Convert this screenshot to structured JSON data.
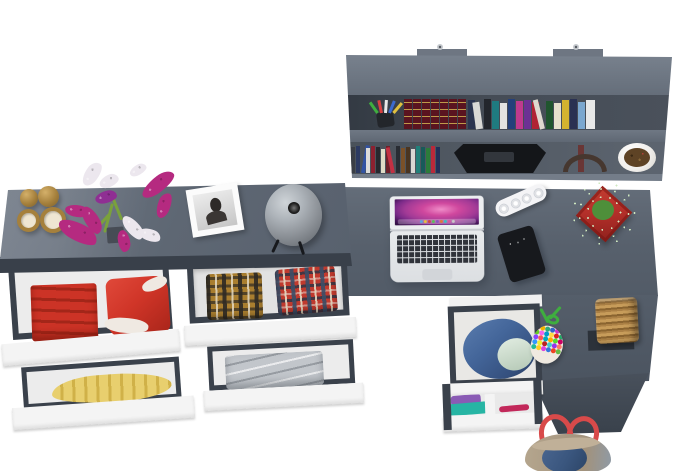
{
  "scene": {
    "type": "3d-furniture-render-top-view",
    "description": "Overhead 3D render of a grey L-shaped desk with wall shelf full of books, a sideboard dresser with open drawers of folded clothes, an open laptop, smartphone, power strip and decorative objects on a white floor",
    "width": 700,
    "height": 471
  },
  "objects": {
    "wall_shelf": "wall-mounted shelf with books, pencil cup, black case, red handbag, planter bowl",
    "dresser": "grey sideboard with candle holders, flower bouquet, photo frame, table lamp",
    "dresser_drawers": "open drawers with red towels, red garment, yellow fabric, two plaid shirts, grey folded sheets",
    "desk": "grey L-shaped desk with open laptop, white power strip, smartphone, potted succulent",
    "drawer_unit": "under-desk drawer unit with blue denim pile and purple, teal and pink folded clothes",
    "return_items": "bead pouch with green cord, wicker basket on dark mat",
    "tote": "canvas and denim tote bag with red straps at desk foot"
  },
  "colors": {
    "floor": "#ffffff",
    "shelf-top": "#6e7682",
    "metal": "#c4c8cd",
    "frame-dark": "#3a414b",
    "drawer-white": "#f4f4f4",
    "interior-white": "#ececec",
    "towel-red": "#cc3326",
    "towel-red-dark": "#a32619",
    "garment-red": "#d03528",
    "garment-white": "#efe9e2",
    "yellow-fabric": "#e8cf6e",
    "yellow-fabric-dark": "#d0b148",
    "sheet-gray": "#c2c6cb",
    "plaid-brown": "#a97e2f",
    "plaid-red": "#c03a2e",
    "denim-blue": "#44669a",
    "denim-dark": "#35507e",
    "denim-light": "#dde9dd",
    "purple-cloth": "#8a5bb5",
    "teal-cloth": "#27b5a4",
    "pink-cloth": "#c2285a",
    "encyclopedia": "#5a1420",
    "encyclopedia-gold": "#caa84e",
    "bag-red": "#e04535",
    "bag-handle": "#46372f",
    "bowl-white": "#f1efec",
    "bowl-soil": "#5e4325",
    "frame-white": "#fbfbfb",
    "photo-bg": "#c6c6c6",
    "brass": "#a5803c",
    "brass-dark": "#7c5f2a",
    "candle-cream": "#efe6d2",
    "flower-magenta": "#b52a80",
    "flower-violet": "#8f2f93",
    "flower-white": "#ece7ee",
    "flower-stem": "#7aa13c",
    "vase-dark": "#474c55",
    "plant-green": "#4e8f3a",
    "plant-green-light": "#7ec06a",
    "pot-red": "#b5302a",
    "pot-red-dark": "#8e211d",
    "basket-dark": "#8a6430",
    "mat-dark": "#2c323a",
    "candy-cord": "#3fae3f",
    "tote-tan": "#b5a68e",
    "tote-denim": "#3a567e",
    "tote-strap": "#d84a4a",
    "laptop-silver": "#e8eaec",
    "laptop-key": "#30333a",
    "screen-pink": "#d0489e",
    "screen-purple": "#7a2a88",
    "screen-dark": "#2a0b3a",
    "phone-black": "#17191d",
    "phone-screen": "#3c5a6a",
    "strip-white": "#f4f4f6"
  },
  "pens": [
    {
      "c": "#3fae3f",
      "r": -35
    },
    {
      "c": "#d84040",
      "r": -12
    },
    {
      "c": "#e8e8e8",
      "r": 4
    },
    {
      "c": "#3a6ad0",
      "r": 22
    },
    {
      "c": "#e0c040",
      "r": 40
    }
  ],
  "books": {
    "encyclopedia": [
      "#5a1420",
      "#5a1420",
      "#5a1420",
      "#5a1420",
      "#5a1420",
      "#5a1420",
      "#5a1420"
    ],
    "upper_right": [
      {
        "c": "#2b3550",
        "h": 29
      },
      {
        "c": "#d9d9d6",
        "h": 27,
        "r": -8
      },
      {
        "c": "#23262c",
        "h": 30
      },
      {
        "c": "#1f7b80",
        "h": 28
      },
      {
        "c": "#e3e3e0",
        "h": 26
      },
      {
        "c": "#24407a",
        "h": 30
      },
      {
        "c": "#bf3a8e",
        "h": 28
      },
      {
        "c": "#6c3194",
        "h": 29
      },
      {
        "c": "#b02334",
        "h": 27
      },
      {
        "c": "#ded9cf",
        "h": 30,
        "r": -14,
        "w": 5
      },
      {
        "c": "#20552e",
        "h": 28
      },
      {
        "c": "#e6e0cc",
        "h": 26
      },
      {
        "c": "#d3b32f",
        "h": 29
      },
      {
        "c": "#2a3152",
        "h": 30
      },
      {
        "c": "#7ba7cf",
        "h": 27
      },
      {
        "c": "#e8e8e8",
        "h": 29,
        "w": 9
      }
    ],
    "lower_left": [
      {
        "c": "#3a3e45",
        "h": 26
      },
      {
        "c": "#2c3a61",
        "h": 27
      },
      {
        "c": "#3253a3",
        "h": 28,
        "r": 10
      },
      {
        "c": "#dcdcda",
        "h": 25
      },
      {
        "c": "#8c2130",
        "h": 27
      },
      {
        "c": "#26292f",
        "h": 26
      },
      {
        "c": "#e0dcc7",
        "h": 24
      },
      {
        "c": "#6e2029",
        "h": 27
      },
      {
        "c": "#c23043",
        "h": 26,
        "r": -12
      },
      {
        "c": "#282c33",
        "h": 27
      },
      {
        "c": "#7a5129",
        "h": 25
      },
      {
        "c": "#4a3521",
        "h": 26
      },
      {
        "c": "#d8d8d4",
        "h": 24
      },
      {
        "c": "#21807a",
        "h": 27
      },
      {
        "c": "#185a5a",
        "h": 26
      },
      {
        "c": "#2c7c3a",
        "h": 25
      },
      {
        "c": "#b9293a",
        "h": 27
      },
      {
        "c": "#223059",
        "h": 26
      }
    ]
  },
  "dock_icons": [
    "#5aa5e0",
    "#e8c23a",
    "#d04545",
    "#58c05a",
    "#8a58c0",
    "#e07838",
    "#3ac0c0",
    "#d858a0",
    "#c8c8c8"
  ],
  "candy_beads": [
    "#e03434",
    "#f5b400",
    "#33aa77",
    "#3366cc",
    "#cc33cc",
    "#f08000",
    "#66cc22",
    "#ee66ee",
    "#0099cc",
    "#ffdd44",
    "#dd2222",
    "#22aa66",
    "#8844ff",
    "#ff5555",
    "#00aabb",
    "#ffaa00",
    "#55dd33",
    "#cc0066",
    "#3399ff",
    "#eeee33",
    "#bb2222",
    "#44cccc",
    "#9933ee",
    "#ff7766",
    "#22bb99",
    "#ffcc22",
    "#dd44dd",
    "#3377dd",
    "#ee4422",
    "#66bb44"
  ]
}
